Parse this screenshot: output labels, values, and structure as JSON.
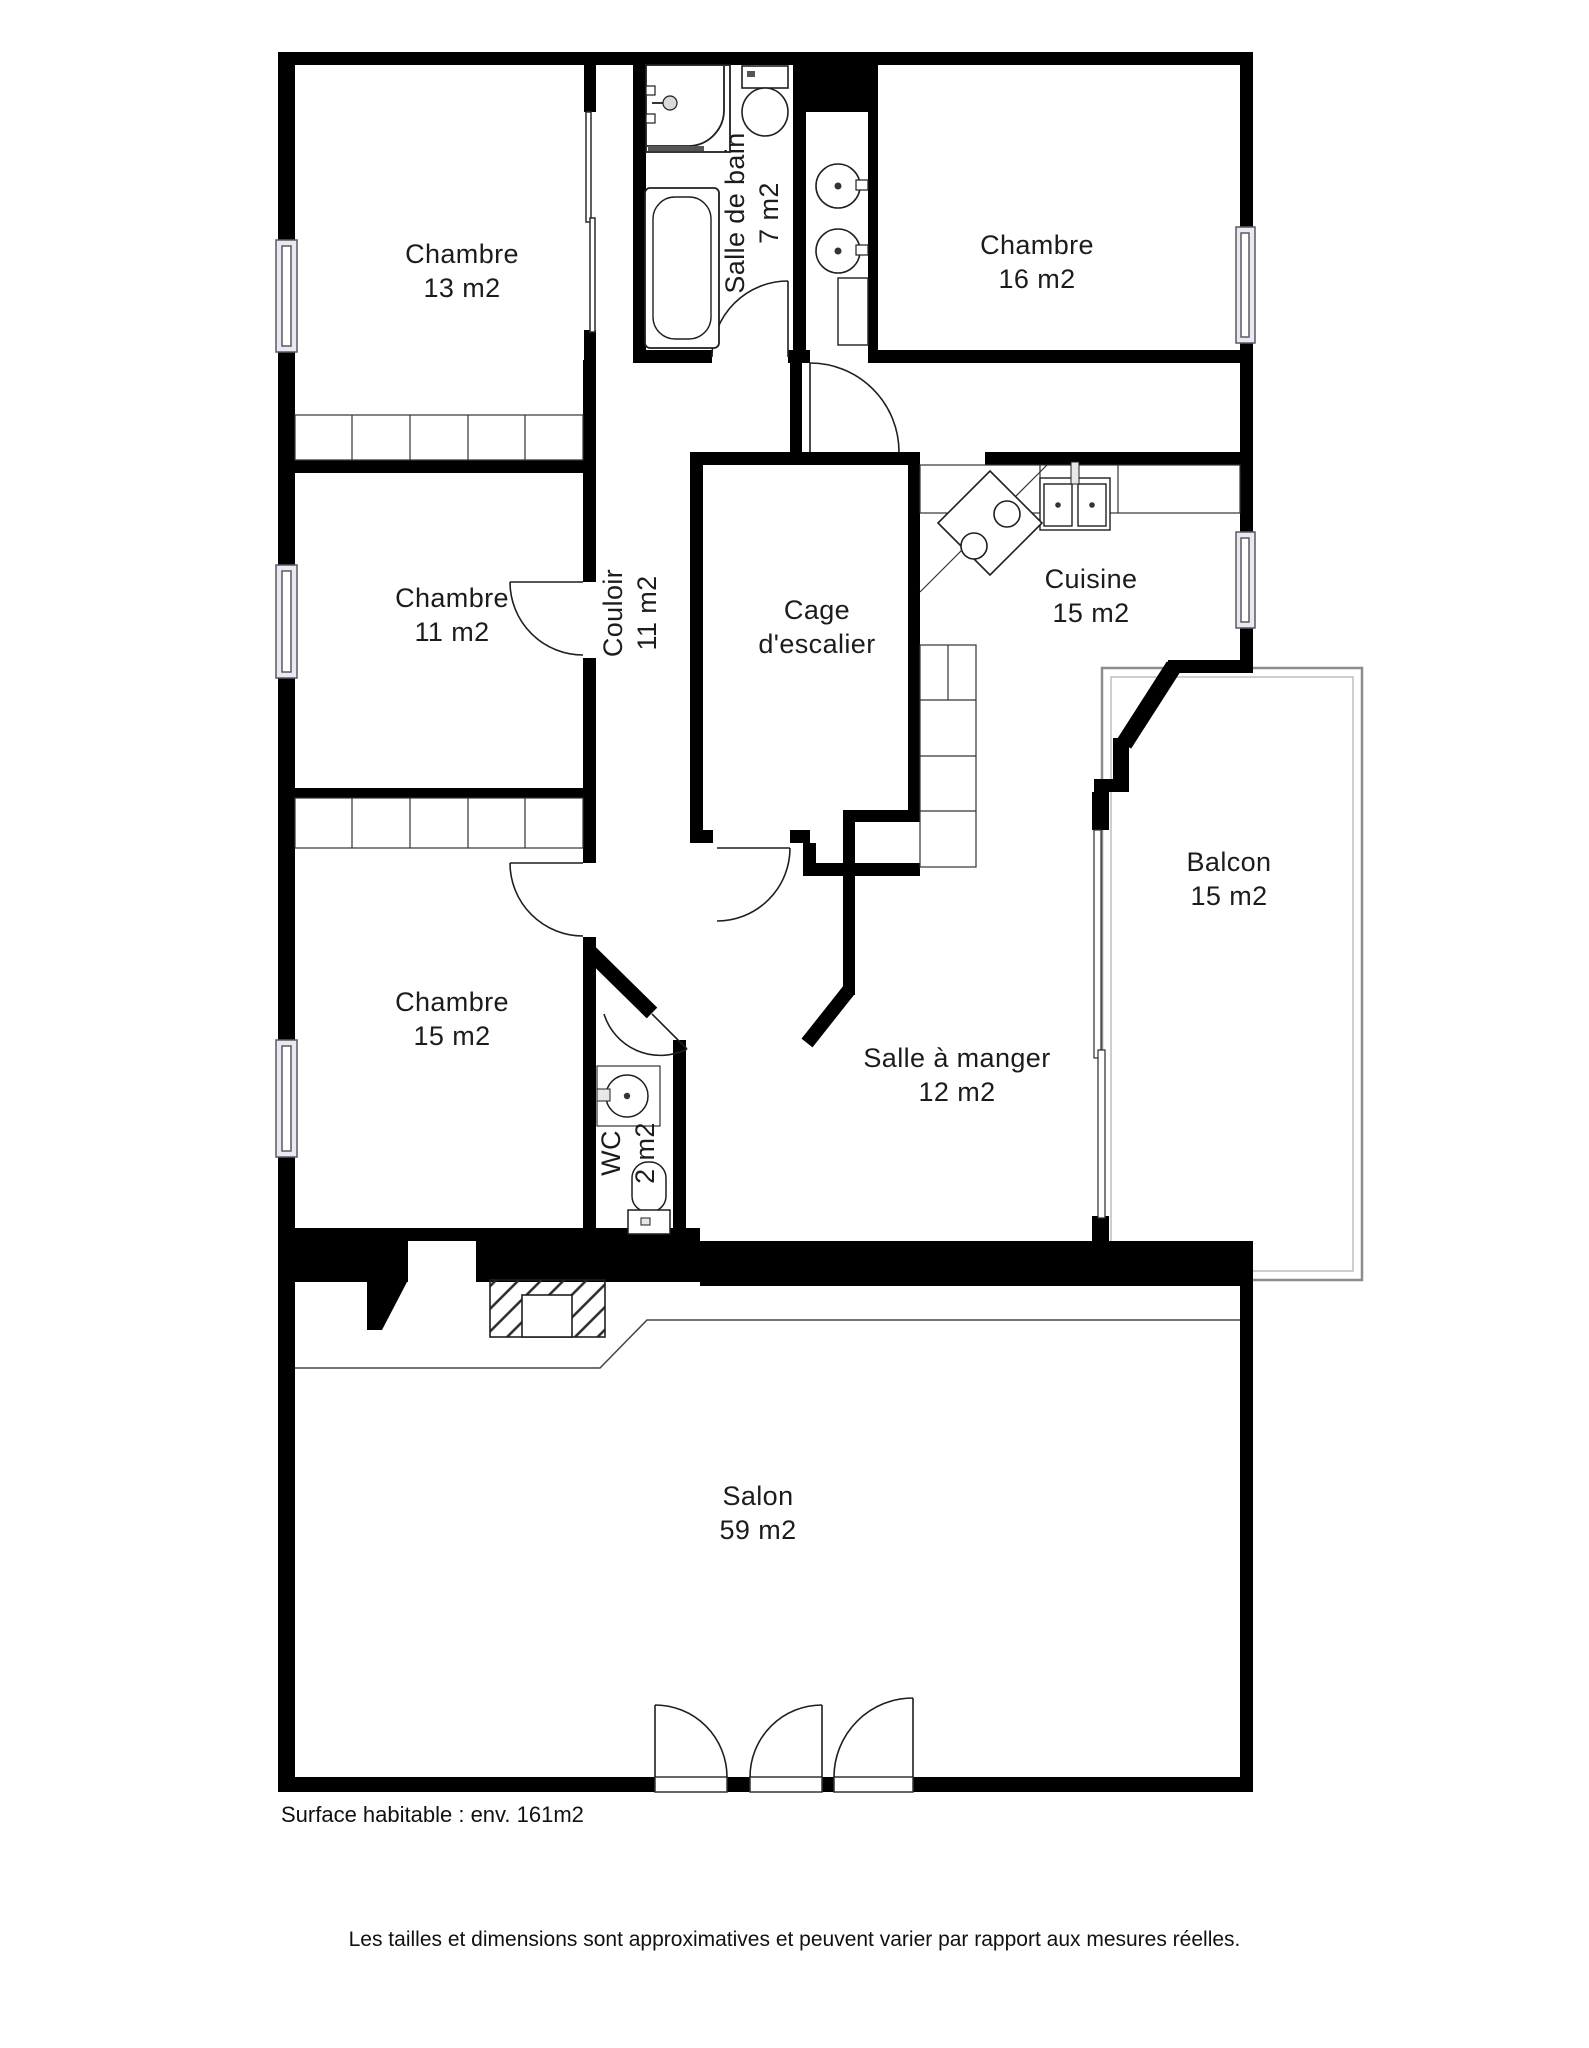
{
  "colors": {
    "wall": "#000000",
    "line": "#2a2a2a",
    "window_fill": "#eae8f4",
    "railing": "#8c8c8c"
  },
  "rooms": [
    {
      "id": "chambre-13",
      "lines": [
        "Chambre",
        "13 m2"
      ]
    },
    {
      "id": "salle-de-bain",
      "lines": [
        "Salle de bain",
        "7 m2"
      ]
    },
    {
      "id": "chambre-16",
      "lines": [
        "Chambre",
        "16 m2"
      ]
    },
    {
      "id": "chambre-11",
      "lines": [
        "Chambre",
        "11 m2"
      ]
    },
    {
      "id": "couloir",
      "lines": [
        "Couloir",
        "11 m2"
      ]
    },
    {
      "id": "cage-escalier",
      "lines": [
        "Cage",
        "d'escalier"
      ]
    },
    {
      "id": "cuisine",
      "lines": [
        "Cuisine",
        "15 m2"
      ]
    },
    {
      "id": "chambre-15",
      "lines": [
        "Chambre",
        "15 m2"
      ]
    },
    {
      "id": "wc",
      "lines": [
        "WC",
        "2 m2"
      ]
    },
    {
      "id": "salle-a-manger",
      "lines": [
        "Salle à manger",
        "12 m2"
      ]
    },
    {
      "id": "balcon",
      "lines": [
        "Balcon",
        "15 m2"
      ]
    },
    {
      "id": "salon",
      "lines": [
        "Salon",
        "59 m2"
      ]
    }
  ],
  "footer": {
    "surface_note": "Surface habitable : env. 161m2",
    "disclaimer": "Les tailles et dimensions sont approximatives et peuvent varier par rapport aux mesures réelles."
  }
}
